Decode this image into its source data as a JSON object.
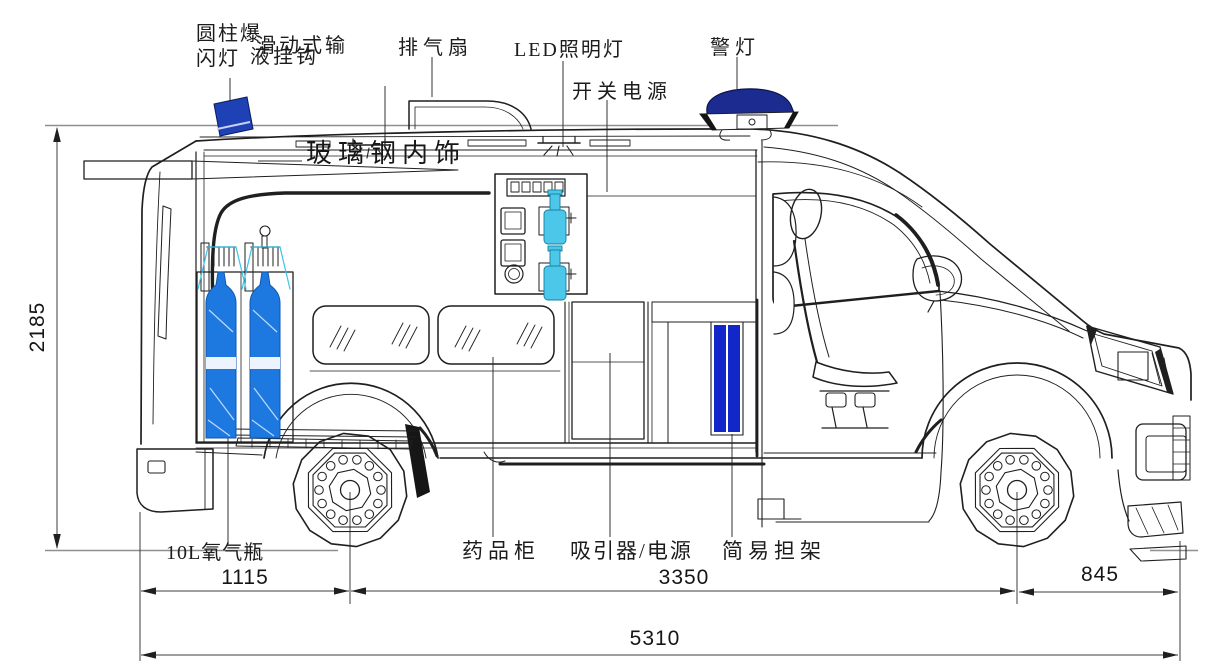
{
  "labels": {
    "strobe_light": "圆柱爆闪灯",
    "iv_hook_line1": "滑动式输",
    "iv_hook_line2": "液挂钩",
    "exhaust_fan": "排气扇",
    "led_light": "LED照明灯",
    "power_switch": "开关电源",
    "warning_light": "警灯",
    "fiberglass_interior": "玻璃钢内饰",
    "oxygen_cylinder": "10L氧气瓶",
    "medicine_cabinet": "药品柜",
    "aspirator_power": "吸引器/电源",
    "stretcher": "简易担架"
  },
  "dimensions": {
    "overall_height": "2185",
    "rear_section": "1115",
    "wheelbase": "3350",
    "front_overhang": "845",
    "overall_length": "5310"
  },
  "colors": {
    "oxygen_bottle_blue": "#1d79e0",
    "stretcher_blue": "#1227c9",
    "beacon_navy": "#1e41b5",
    "warning_light_navy": "#1c2b8f",
    "suction_bottle_cyan": "#4cc7ea",
    "line_dark": "#1f1f1f",
    "dimension_gray": "#3c3c3c"
  }
}
